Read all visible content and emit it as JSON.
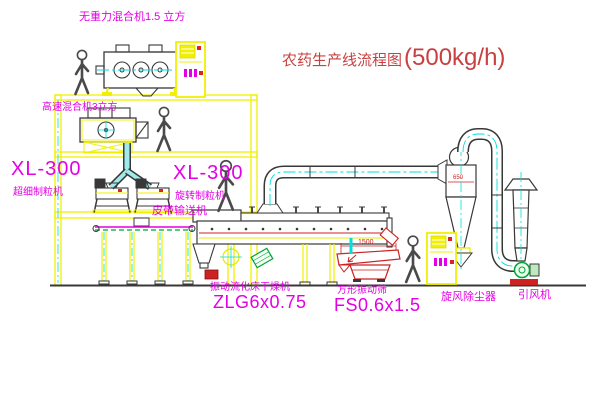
{
  "title": {
    "text": "农药生产线流程图",
    "capacity": "(500kg/h)"
  },
  "labels": {
    "top_mixer": "无重力混合机1.5 立方",
    "high_speed_mixer": "高速混合机3立方",
    "xl300_left": "XL-300",
    "granulator_left": "超细制粒机",
    "xl300_mid": "XL-300",
    "granulator_mid": "旋转制粒机",
    "belt_conveyor": "皮带输送机",
    "dryer": "振动流化床干燥机",
    "dryer_model": "ZLG6x0.75",
    "sieve": "方形振动筛",
    "sieve_model": "FS0.6x1.5",
    "cyclone": "旋风除尘器",
    "fan": "引风机"
  },
  "dimensions": {
    "sieve_length": "1500",
    "cyclone_diameter": "650"
  },
  "colors": {
    "background": "#ffffff",
    "structure_yellow": "#f0f000",
    "centerline_cyan": "#00dede",
    "label_magenta": "#e400e4",
    "title_red": "#c84040",
    "line_dark": "#383838",
    "equipment_red": "#cc2222",
    "green": "#00a33c"
  }
}
